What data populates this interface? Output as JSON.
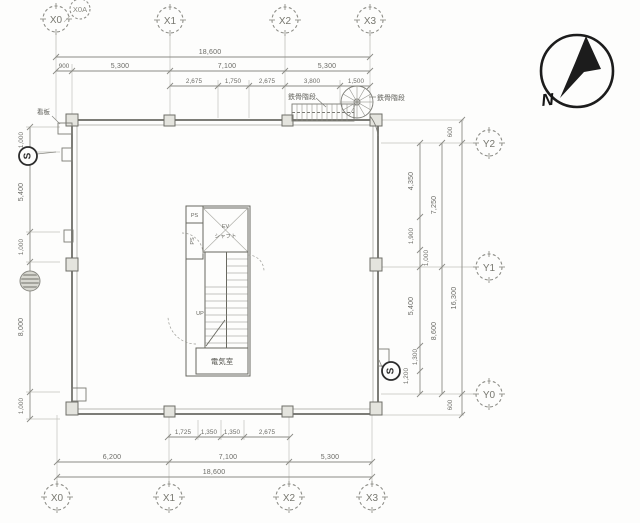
{
  "colors": {
    "paper": "#fdfdfc",
    "line": "#8c8c86",
    "wall": "#6e6e68",
    "compass": "#1c1c1c"
  },
  "grid": {
    "top": [
      "X0",
      "X0A",
      "X1",
      "X2",
      "X3"
    ],
    "bottom": [
      "X0",
      "X1",
      "X2",
      "X3"
    ],
    "right": [
      "Y2",
      "Y1",
      "Y0"
    ]
  },
  "dims": {
    "top": {
      "total": "18,600",
      "row": [
        "900",
        "5,300",
        "7,100",
        "5,300"
      ],
      "sub": [
        "2,675",
        "1,750",
        "2,675",
        "3,800",
        "1,500"
      ]
    },
    "bottom": {
      "total": "18,600",
      "row": [
        "6,200",
        "7,100",
        "5,300"
      ],
      "sub": [
        "1,725",
        "1,350",
        "1,350",
        "2,675"
      ]
    },
    "left": {
      "segments": [
        "1,000",
        "5,400",
        "1,000",
        "8,000",
        "1,000"
      ]
    },
    "right": {
      "offset_top": "600",
      "upper_segments": [
        "4,350",
        "1,900",
        "1,000"
      ],
      "upper_subtotal": "7,250",
      "lower_segments": [
        "5,400",
        "1,300",
        "1,200"
      ],
      "lower_subtotal": "8,600",
      "total": "16,300",
      "offset_bottom": "600"
    }
  },
  "annotations": {
    "signboard": "看板",
    "steel_stair_left": "鉄骨階段",
    "steel_stair_right": "鉄骨階段",
    "north_label": "N",
    "section_marker": "S"
  },
  "core": {
    "ps_top": "PS",
    "ps_left": "PS",
    "ev_line1": "EV",
    "ev_line2": "シャフト",
    "stair_up": "UP",
    "electrical_room": "電気室"
  }
}
